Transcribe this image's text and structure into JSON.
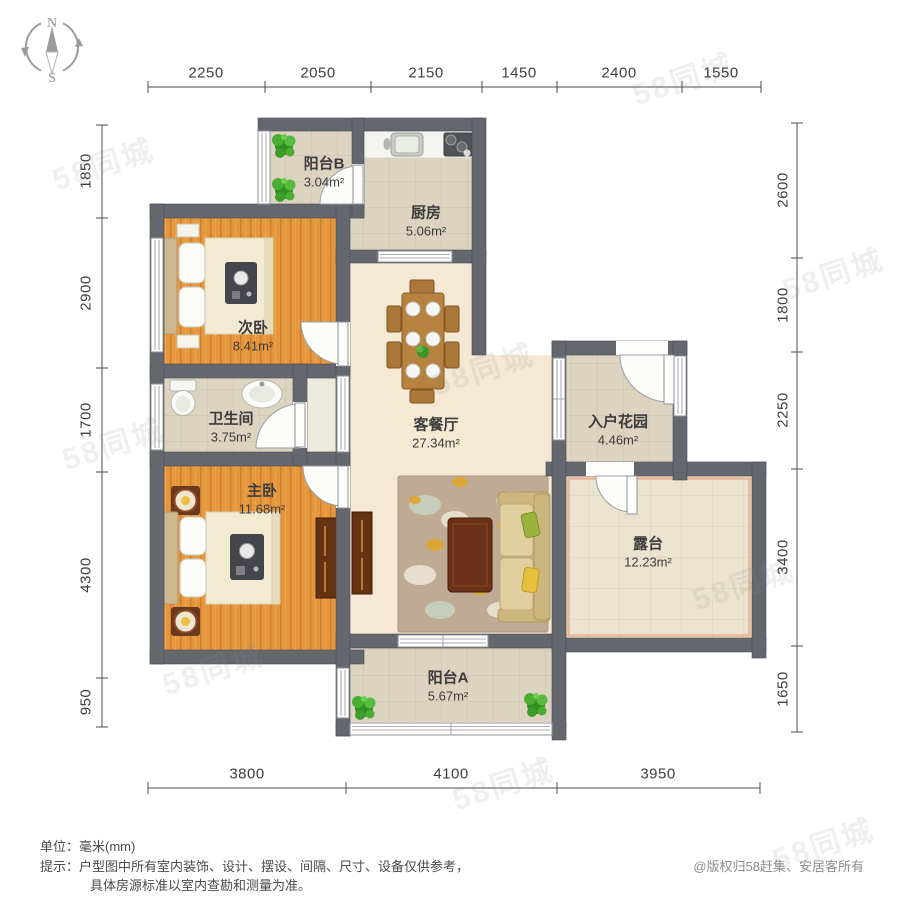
{
  "watermark_text": "58同城",
  "compass": {
    "north": "N",
    "south": "S"
  },
  "dimensions": {
    "top": [
      "2250",
      "2050",
      "2150",
      "1450",
      "2400",
      "1550"
    ],
    "left": [
      "1850",
      "2900",
      "1700",
      "4300",
      "950"
    ],
    "right": [
      "2600",
      "1800",
      "2250",
      "3400",
      "1650"
    ],
    "bottom": [
      "3800",
      "4100",
      "3950"
    ]
  },
  "rooms": {
    "balcony_b": {
      "name": "阳台B",
      "area": "3.04m²"
    },
    "kitchen": {
      "name": "厨房",
      "area": "5.06m²"
    },
    "second_bedroom": {
      "name": "次卧",
      "area": "8.41m²"
    },
    "bathroom": {
      "name": "卫生间",
      "area": "3.75m²"
    },
    "living_dining": {
      "name": "客餐厅",
      "area": "27.34m²"
    },
    "entry_garden": {
      "name": "入户花园",
      "area": "4.46m²"
    },
    "master_bedroom": {
      "name": "主卧",
      "area": "11.68m²"
    },
    "terrace": {
      "name": "露台",
      "area": "12.23m²"
    },
    "balcony_a": {
      "name": "阳台A",
      "area": "5.67m²"
    }
  },
  "footer": {
    "unit_line": "单位：毫米(mm)",
    "tip_line1": "提示：户型图中所有室内装饰、设计、摆设、间隔、尺寸、设备仅供参考，",
    "tip_line2": "具体房源标准以室内查勘和测量为准。",
    "copyright": "@版权归58赶集、安居客所有"
  },
  "colors": {
    "wall": "#64686e",
    "wood_floor": "#e5973d",
    "living_floor": "#f5e9d4",
    "tile": "#dcd4c0",
    "terrace_tile": "#eae3cf"
  }
}
